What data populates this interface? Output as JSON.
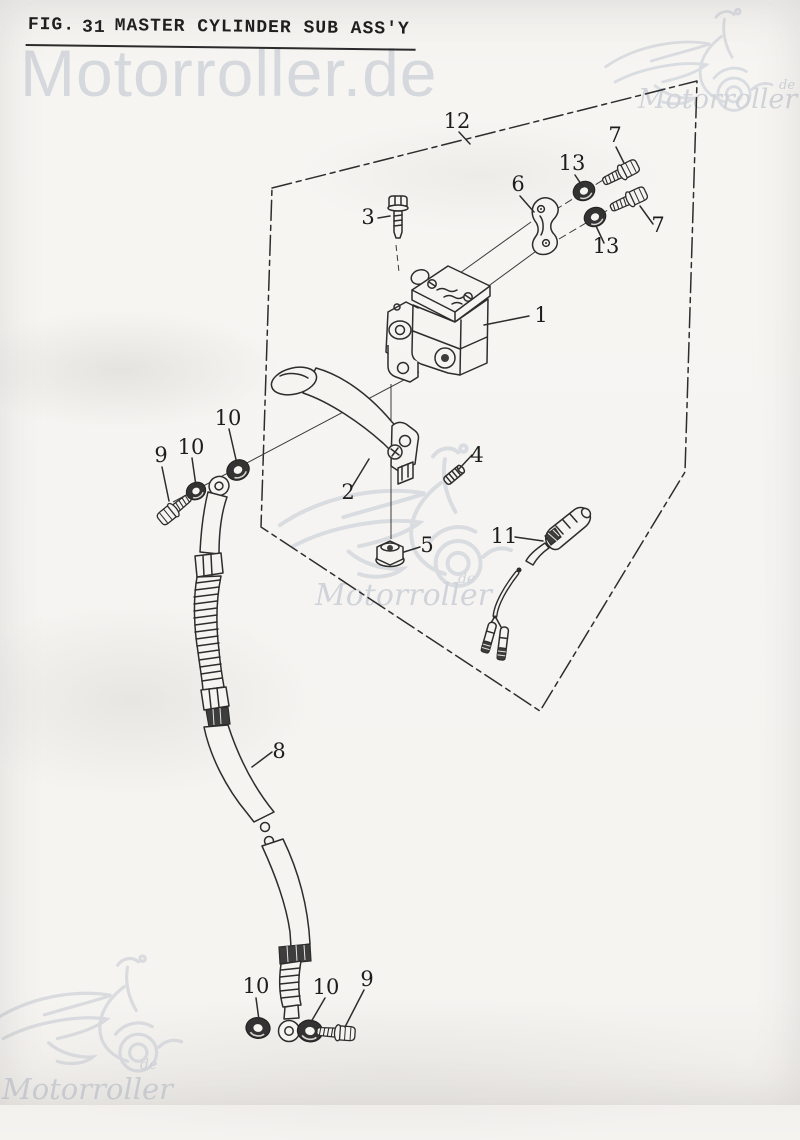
{
  "title": {
    "prefix": "FIG.",
    "number": "31",
    "name": "MASTER CYLINDER SUB ASS'Y"
  },
  "watermarks": {
    "top_text": "Motorroller.de",
    "brand": "Motorroller",
    "domain_suffix": "de"
  },
  "callouts": [
    {
      "num": "12"
    },
    {
      "num": "7"
    },
    {
      "num": "13"
    },
    {
      "num": "6"
    },
    {
      "num": "3"
    },
    {
      "num": "1"
    },
    {
      "num": "7"
    },
    {
      "num": "13"
    },
    {
      "num": "2"
    },
    {
      "num": "4"
    },
    {
      "num": "5"
    },
    {
      "num": "11"
    },
    {
      "num": "9"
    },
    {
      "num": "10"
    },
    {
      "num": "10"
    },
    {
      "num": "8"
    },
    {
      "num": "10"
    },
    {
      "num": "10"
    },
    {
      "num": "9"
    }
  ],
  "colors": {
    "ink": "#2d2d2d",
    "paper": "#f5f4f1",
    "watermark": "#b8bec9"
  }
}
